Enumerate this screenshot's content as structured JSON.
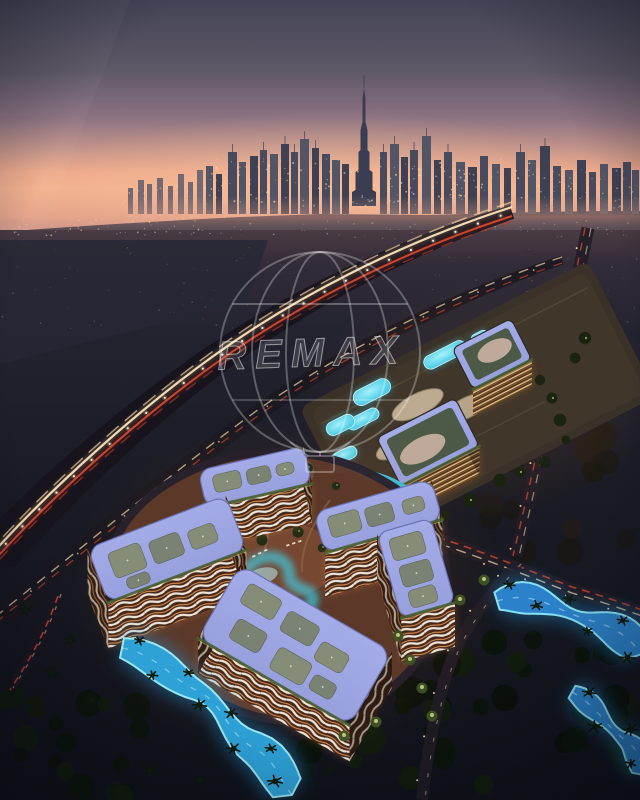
{
  "meta": {
    "alt": "Aerial dusk rendering of a residential community with glowing blue pools and lazy-river lagoons, an illuminated resort complex, light-trailed highways, and the Dubai skyline with Burj Khalifa under a pink sunset horizon"
  },
  "watermark": {
    "text": "REMAX"
  },
  "palette": {
    "sky_top": "#434456",
    "sky_mauve": "#8d7382",
    "horizon_glow": "#f3b08d",
    "skyline_silhouette": "#42455a",
    "ground_dark": "#15161f",
    "rooftop_periwinkle": "#97a0dd",
    "pool_cyan": "#3cc6e4",
    "lazy_river_blue": "#2f9fe0",
    "balcony_white": "#eee6da",
    "interior_warm": "#e09050",
    "headlights": "#ffe3b8",
    "taillights": "#e04a2c",
    "foliage_dark": "#16200f",
    "courtyard_terracotta": "#6b3f2c"
  }
}
